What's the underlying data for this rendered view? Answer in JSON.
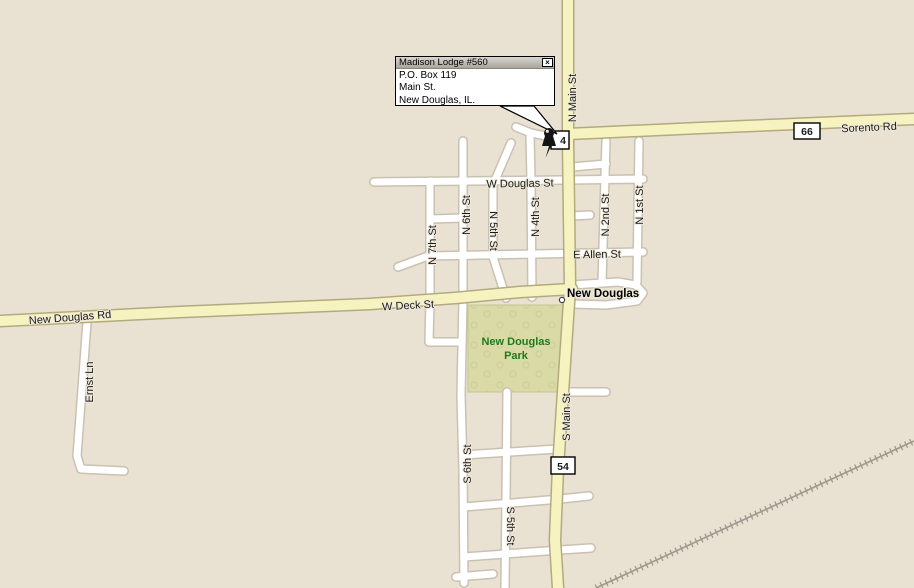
{
  "map": {
    "town": {
      "name": "New Douglas"
    },
    "park": {
      "line1": "New Douglas",
      "line2": "Park",
      "fill": "#d9daa6",
      "text_color": "#1f7a1f"
    },
    "street_labels": {
      "n_main_st": "N Main St",
      "s_main_st": "S Main St",
      "sorento_rd": "Sorento Rd",
      "w_douglas_st": "W Douglas St",
      "e_allen_st": "E Allen St",
      "w_deck_st": "W Deck St",
      "new_douglas_rd": "New Douglas Rd",
      "ernst_ln": "Ernst Ln",
      "n_7th_st": "N 7th St",
      "n_6th_st": "N 6th St",
      "n_5th_st": "N 5th St",
      "n_4th_st": "N 4th St",
      "n_2nd_st": "N 2nd St",
      "n_1st_st": "N 1st St",
      "s_6th_st": "S 6th St",
      "s_5th_st": "S 5th St"
    },
    "shields": {
      "route_66": "66",
      "route_54_south": "54",
      "route_54_north_visible": "4"
    },
    "colors": {
      "background": "#e9e1d1",
      "major_road_fill": "#f7f3c0",
      "major_road_casing": "#b3aa80",
      "minor_road_fill": "#ffffff",
      "minor_road_casing": "#c9c1b1",
      "railroad": "#9e988e",
      "label_text": "#1b1b1b"
    }
  },
  "callout": {
    "title": "Madison Lodge #560",
    "close_label": "×",
    "address_lines": [
      "P.O. Box 119",
      "Main St.",
      "New Douglas, IL."
    ]
  }
}
